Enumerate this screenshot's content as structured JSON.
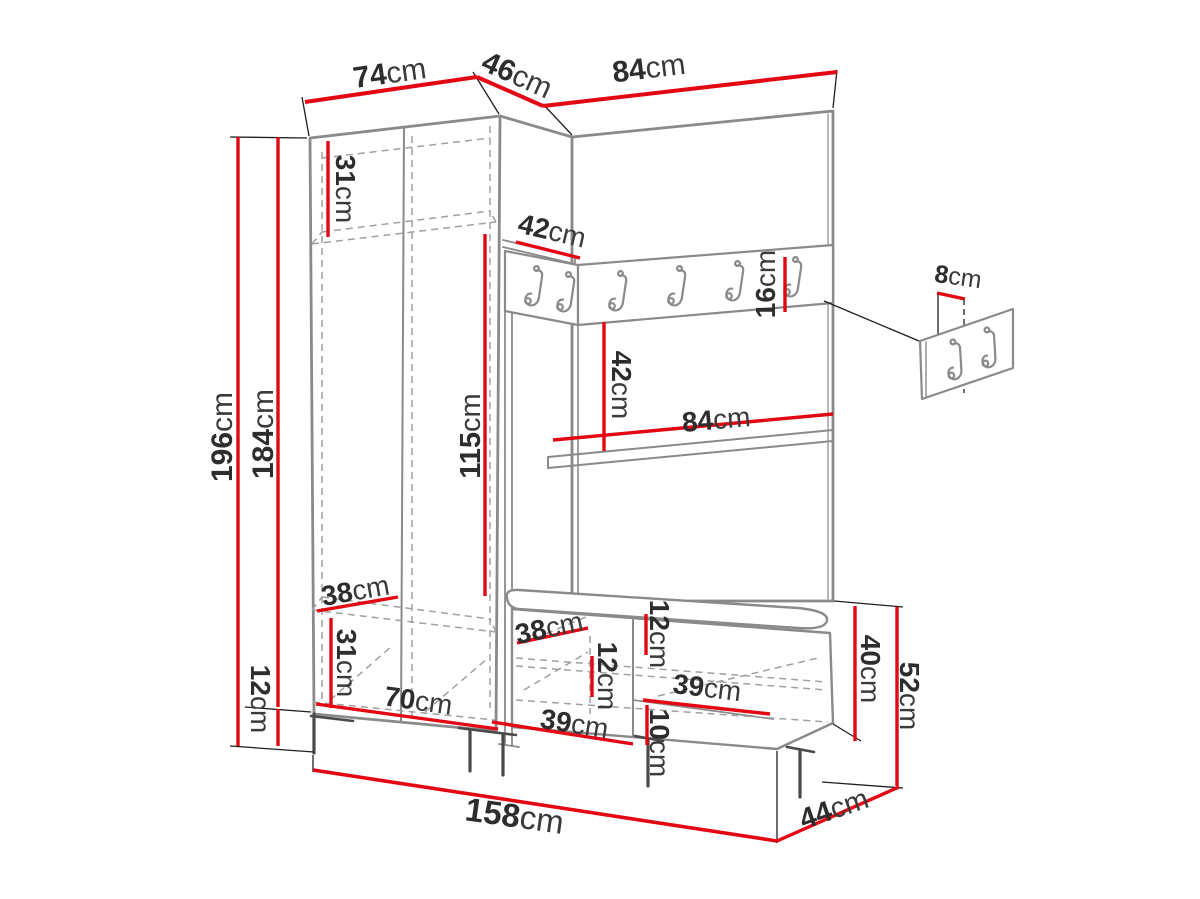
{
  "diagram": {
    "kind": "furniture-dimension-diagram",
    "unit": "cm",
    "accent_color": "#e30613",
    "dimensions": {
      "wardrobe_width": {
        "v": "74",
        "u": "cm"
      },
      "corner_width": {
        "v": "46",
        "u": "cm"
      },
      "panel_width": {
        "v": "84",
        "u": "cm"
      },
      "total_height": {
        "v": "196",
        "u": "cm"
      },
      "cabinet_height": {
        "v": "184",
        "u": "cm"
      },
      "top_compartment_height": {
        "v": "31",
        "u": "cm"
      },
      "corner_shelf_depth": {
        "v": "42",
        "u": "cm"
      },
      "hanging_space_height": {
        "v": "115",
        "u": "cm"
      },
      "rail_height": {
        "v": "16",
        "u": "cm"
      },
      "rail_to_shelf_height": {
        "v": "42",
        "u": "cm"
      },
      "shelf_width": {
        "v": "84",
        "u": "cm"
      },
      "wardrobe_shelf_depth": {
        "v": "38",
        "u": "cm"
      },
      "bottom_compartment_height": {
        "v": "31",
        "u": "cm"
      },
      "interior_width": {
        "v": "70",
        "u": "cm"
      },
      "leg_height": {
        "v": "12",
        "u": "cm"
      },
      "plinth_width": {
        "v": "39",
        "u": "cm"
      },
      "bench_shelf_depth": {
        "v": "38",
        "u": "cm"
      },
      "cushion_thickness": {
        "v": "12",
        "u": "cm"
      },
      "bench_compartment_height": {
        "v": "12",
        "u": "cm"
      },
      "bench_interior_width": {
        "v": "39",
        "u": "cm"
      },
      "bench_bottom_height": {
        "v": "10",
        "u": "cm"
      },
      "bench_body_height": {
        "v": "40",
        "u": "cm"
      },
      "bench_total_height": {
        "v": "52",
        "u": "cm"
      },
      "bench_depth": {
        "v": "44",
        "u": "cm"
      },
      "total_width": {
        "v": "158",
        "u": "cm"
      },
      "hook_panel_offset": {
        "v": "8",
        "u": "cm"
      }
    }
  }
}
